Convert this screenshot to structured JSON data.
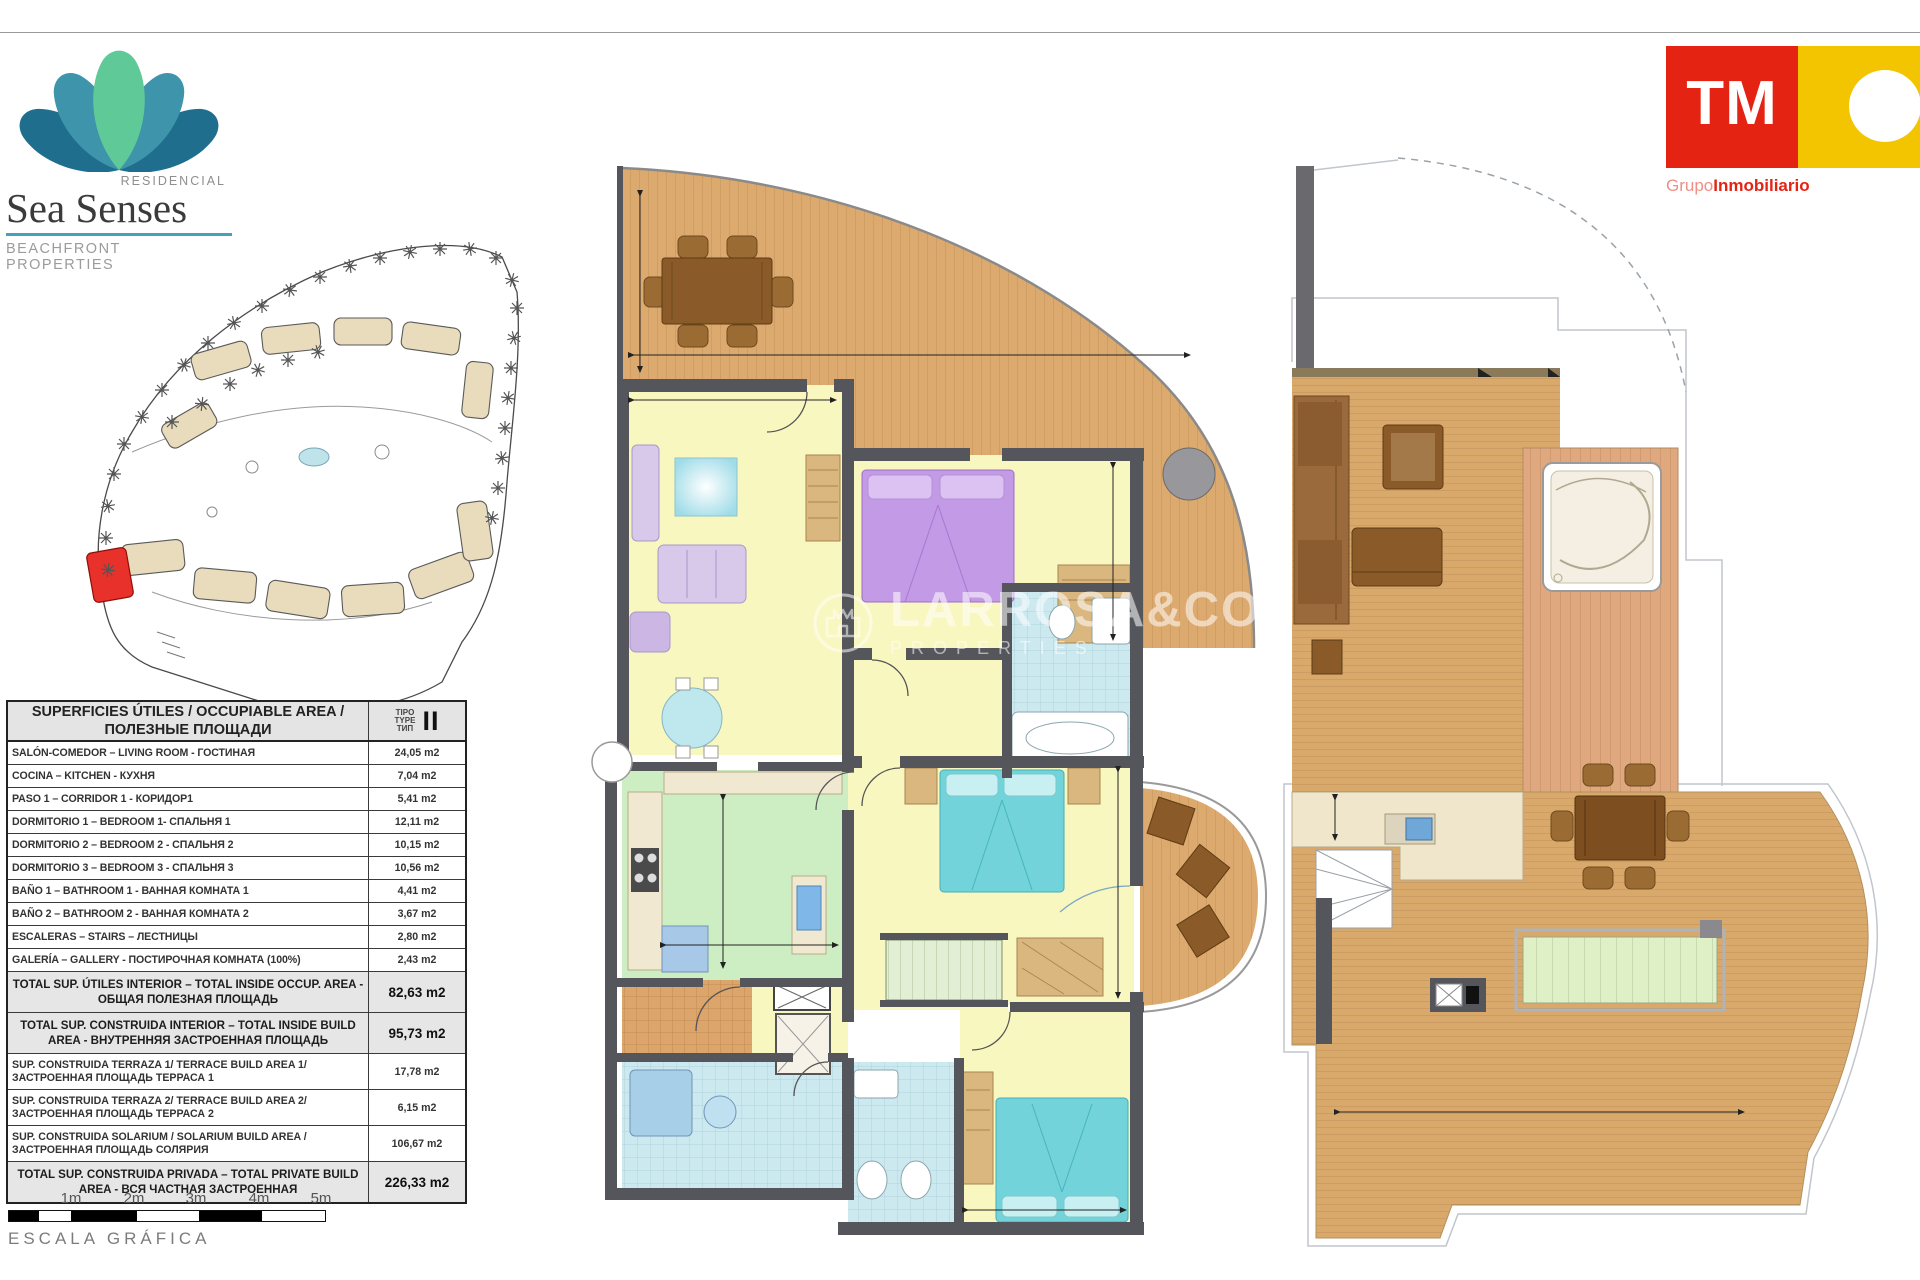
{
  "brand": {
    "residencial": "RESIDENCIAL",
    "name": "Sea Senses",
    "tagline": "BEACHFRONT PROPERTIES"
  },
  "tm": {
    "initials": "TM",
    "grupo": "Grupo",
    "inmobiliario": "Inmobiliario"
  },
  "watermark": {
    "name": "LARROSA&CO",
    "sub": "PROPERTIES"
  },
  "areas_table": {
    "title": "SUPERFICIES ÚTILES / OCCUPIABLE AREA / ПОЛЕЗНЫЕ ПЛОЩАДИ",
    "type_lines": [
      "TIPO",
      "TYPE",
      "ТИП"
    ],
    "type_value": "II",
    "rows": [
      {
        "label": "SALÓN-COMEDOR – LIVING ROOM - ГОСТИНАЯ",
        "value": "24,05 m2"
      },
      {
        "label": "COCINA – KITCHEN - КУХНЯ",
        "value": "7,04 m2"
      },
      {
        "label": "PASO 1 – CORRIDOR 1 - КОРИДОР1",
        "value": "5,41 m2"
      },
      {
        "label": "DORMITORIO 1 –  BEDROOM 1- СПАЛЬНЯ 1",
        "value": "12,11 m2"
      },
      {
        "label": "DORMITORIO 2 – BEDROOM 2 - СПАЛЬНЯ 2",
        "value": "10,15 m2"
      },
      {
        "label": "DORMITORIO 3 – BEDROOM 3 - СПАЛЬНЯ 3",
        "value": "10,56 m2"
      },
      {
        "label": "BAÑO 1 – BATHROOM 1 - ВАННАЯ КОМНАТА 1",
        "value": "4,41 m2"
      },
      {
        "label": "BAÑO 2 – BATHROOM 2 - ВАННАЯ КОМНАТА 2",
        "value": "3,67 m2"
      },
      {
        "label": "ESCALERAS – STAIRS – ЛЕСТНИЦЫ",
        "value": "2,80 m2"
      },
      {
        "label": "GALERÍA – GALLERY - ПОСТИРОЧНАЯ КОМНАТА (100%)",
        "value": "2,43 m2"
      },
      {
        "label": "TOTAL SUP. ÚTILES INTERIOR –  TOTAL INSIDE OCCUP. AREA - ОБЩАЯ ПОЛЕЗНАЯ ПЛОЩАДЬ",
        "value": "82,63 m2"
      },
      {
        "label": "TOTAL SUP. CONSTRUIDA INTERIOR –  TOTAL INSIDE BUILD AREA - ВНУТРЕННЯЯ ЗАСТРОЕННАЯ ПЛОЩАДЬ",
        "value": "95,73 m2"
      },
      {
        "label": "SUP. CONSTRUIDA TERRAZA 1/ TERRACE BUILD AREA 1/ ЗАСТРОЕННАЯ ПЛОЩАДЬ ТЕРРАСА 1",
        "value": "17,78 m2"
      },
      {
        "label": "SUP. CONSTRUIDA TERRAZA 2/ TERRACE BUILD AREA 2/ ЗАСТРОЕННАЯ ПЛОЩАДЬ ТЕРРАСА 2",
        "value": "6,15 m2"
      },
      {
        "label": "SUP. CONSTRUIDA SOLARIUM / SOLARIUM BUILD AREA / ЗАСТРОЕННАЯ ПЛОЩАДЬ СОЛЯРИЯ",
        "value": "106,67 m2"
      },
      {
        "label": "TOTAL SUP. CONSTRUIDA PRIVADA – TOTAL PRIVATE BUILD AREA - ВСЯ ЧАСТНАЯ ЗАСТРОЕННАЯ",
        "value": "226,33 m2"
      }
    ]
  },
  "scale": {
    "labels": [
      "1m",
      "2m",
      "3m",
      "4m",
      "5m"
    ],
    "caption": "ESCALA GRÁFICA"
  },
  "colors": {
    "accent_teal": "#44a3b6",
    "tm_red": "#e42313",
    "tm_yellow": "#f2c500",
    "wall": "#55565b",
    "floor": "#f9f7c0",
    "deck_wood": "#dcaa6e",
    "kitchen_green": "#cdeec3",
    "bath_blue": "#cde9f0",
    "bed_purple": "#c39ae6",
    "bed_turquoise": "#72d4da",
    "highlight_red": "#e8312a"
  }
}
